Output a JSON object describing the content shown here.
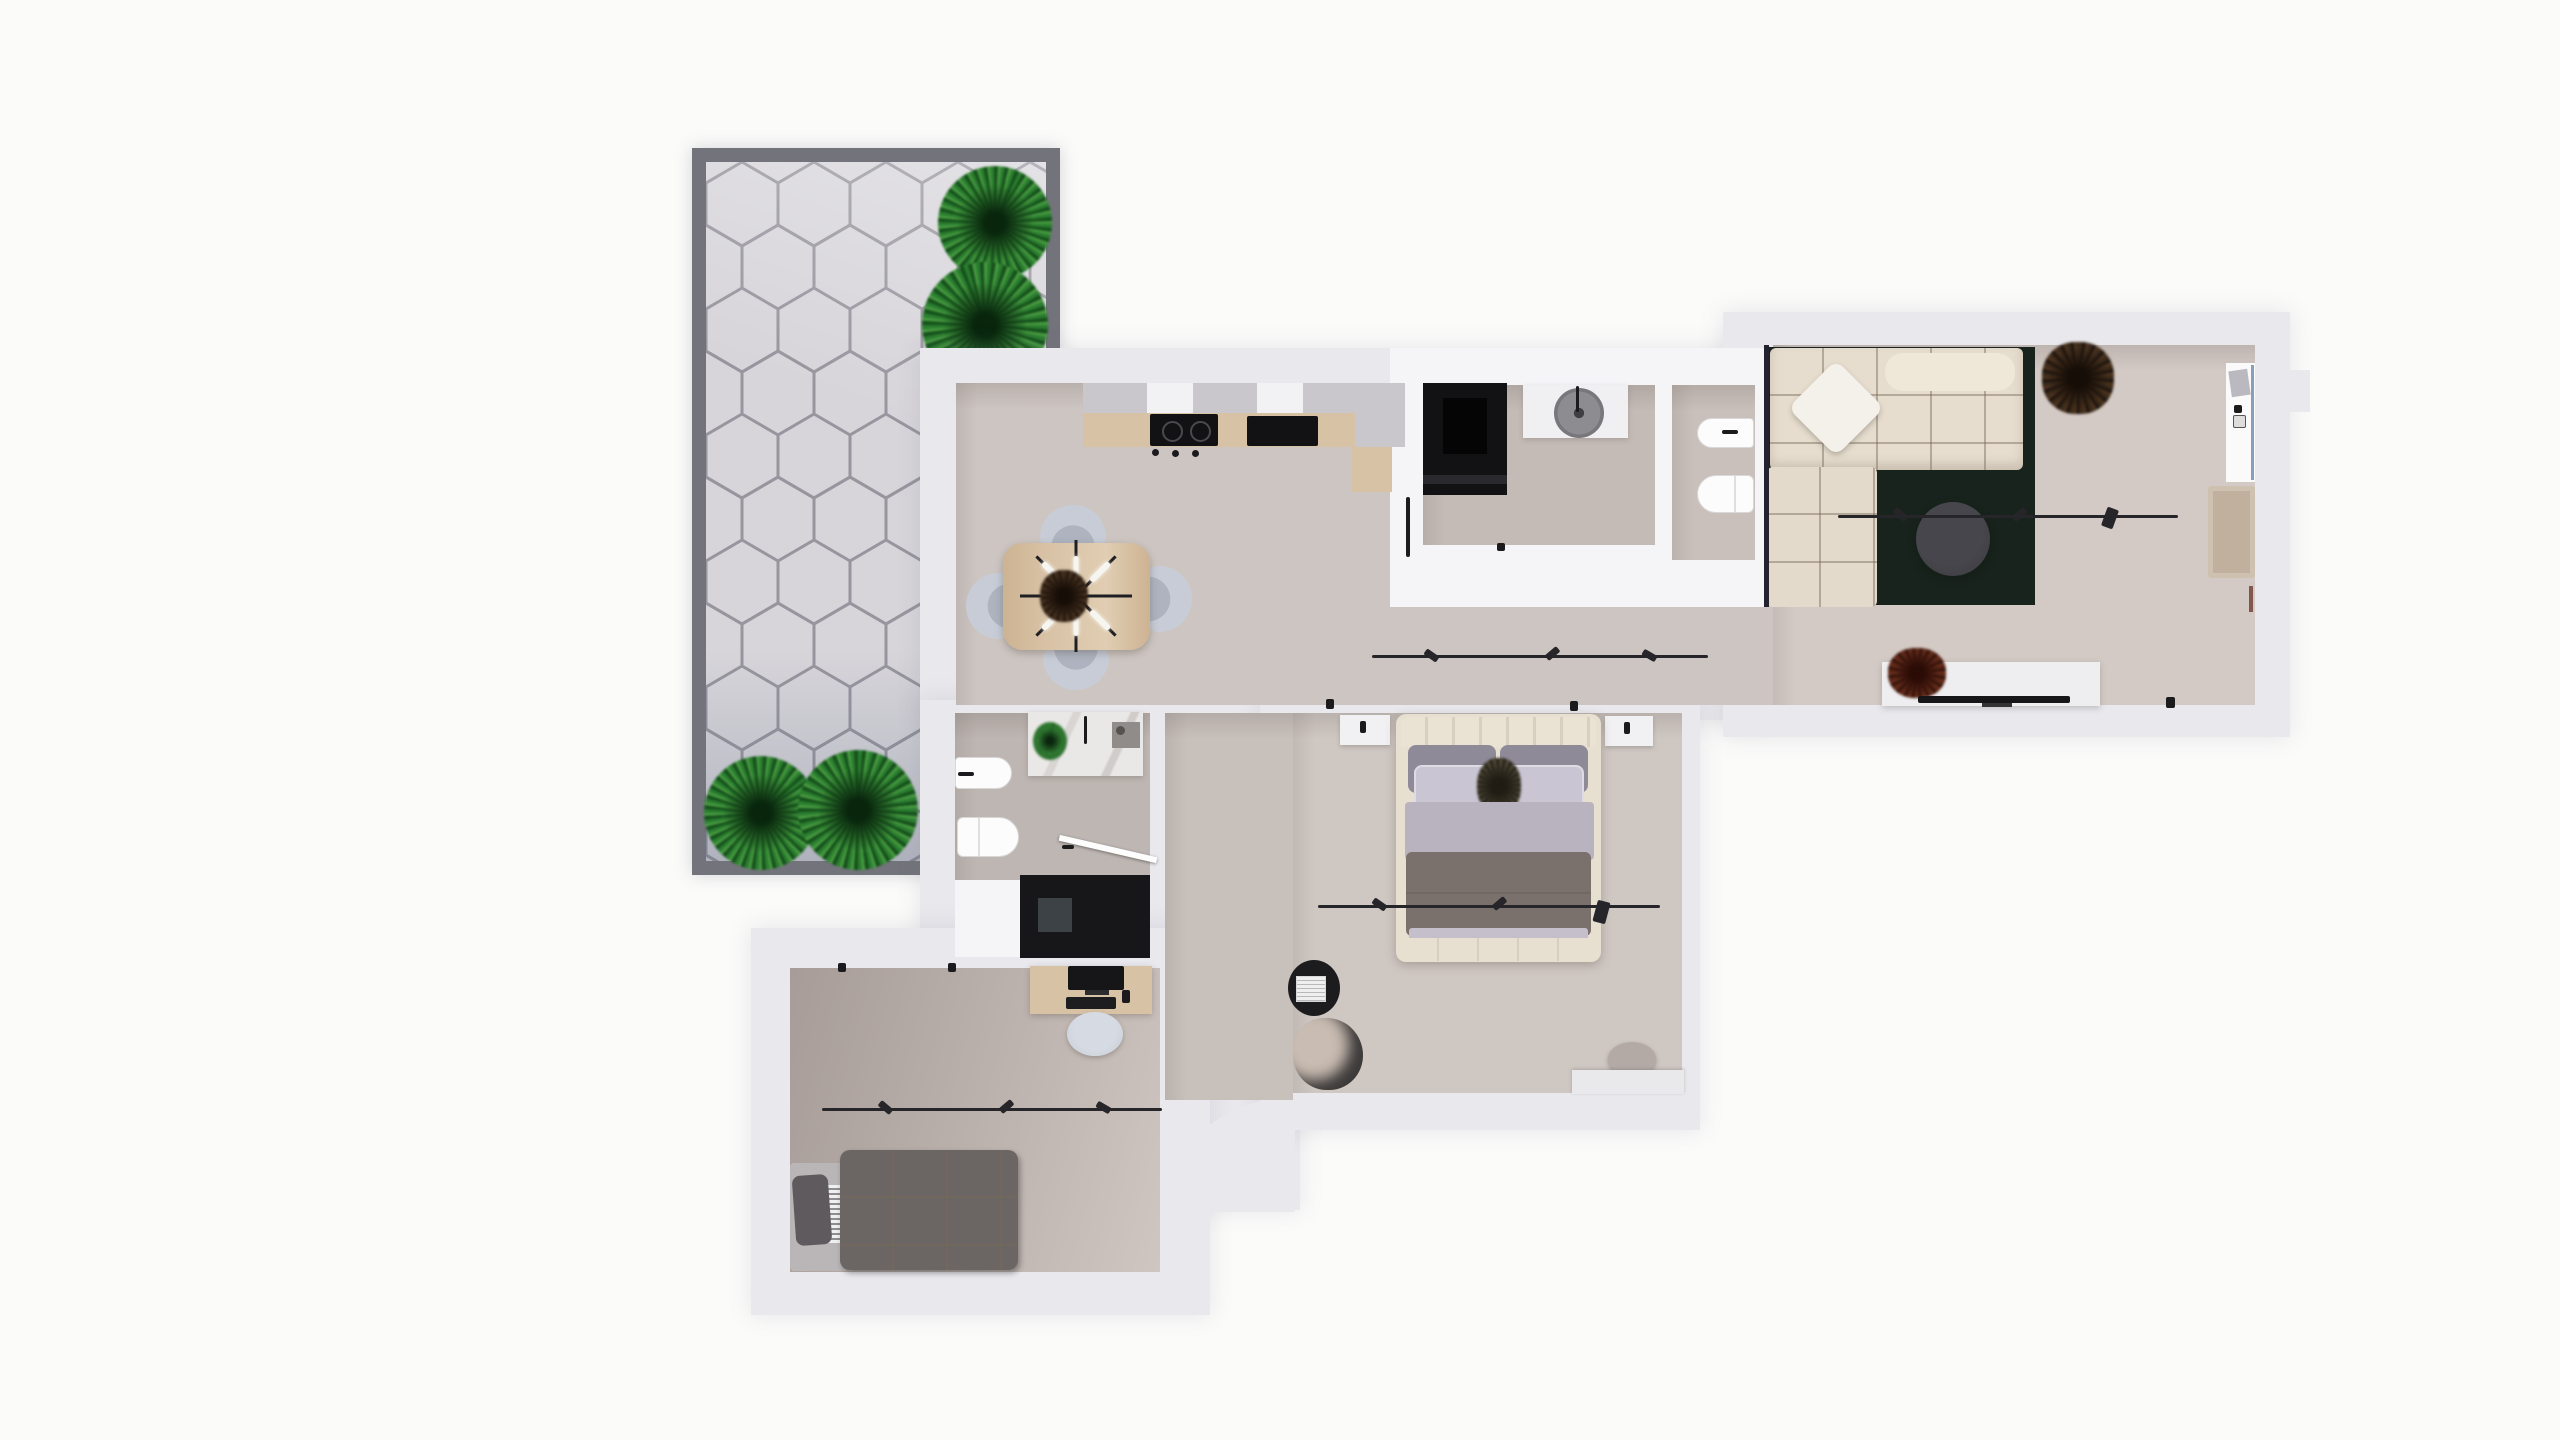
{
  "meta": {
    "description": "Top-down 3D rendered floor plan of an apartment with terrace, no visible text labels",
    "view": "orthographic top view",
    "visible_text": []
  },
  "colors": {
    "bg": "#fbfbfa",
    "wall": "#e8e8ed",
    "wall_bright": "#f5f5f8",
    "terrace_border": "#73737b",
    "terrace_tile": "#d7d5da",
    "terrace_grout": "#97959e",
    "plant_dark": "#17501d",
    "plant_mid": "#2e7d32",
    "plant_light": "#4c9a45",
    "floor_kitchen": "#cdc5c1",
    "floor_living": "#d4cac5",
    "floor_bedroom": "#cfc7c2",
    "floor_bath": "#beb6b2",
    "floor_corridor": "#c8c0bb",
    "floor_laundry": "#c4bbb6",
    "floor_wc": "#c9c0bb",
    "floor_office_dark": "#a79c98",
    "floor_office_light": "#cfc6c1",
    "wood": "#d8c2a6",
    "sofa": "#e6ddcf",
    "sofa_light": "#efe7d8",
    "pillow_white": "#f4f1ea",
    "rug": "#17231c",
    "table_dark": "#3a3a3f",
    "black": "#161618",
    "appliance": "#121214",
    "chair_gray": "#c7ccd6",
    "bed_frame": "#e7dfd0",
    "pillow_gray": "#8f8a98",
    "pillow_light": "#c9c5d2",
    "sheet": "#b8b3bf",
    "duvet": "#7a716c",
    "daybed_duvet": "#6b6564",
    "daybed_base": "#bab6b7",
    "marble": "#eae8e7",
    "track": "#26262a",
    "glass_blue": "#5577a0",
    "console_white": "#eeedef",
    "tan_chair": "#cfc1b0"
  },
  "terrace": {
    "paving": "hexagonal-tiles",
    "plants": [
      "bush-top-1",
      "bush-top-2",
      "bush-bottom-1",
      "bush-bottom-2"
    ]
  },
  "rooms": [
    {
      "name": "kitchen-dining",
      "furniture": [
        "upper-cabinets",
        "wood-counter",
        "cooktop",
        "dark-sink",
        "corner-cabinet",
        "dining-table",
        "sputnik-chandelier",
        "dining-chair-north",
        "dining-chair-south",
        "dining-chair-east",
        "dining-chair-west"
      ]
    },
    {
      "name": "laundry",
      "furniture": [
        "washing-machine",
        "white-counter",
        "round-basin",
        "door-leaf"
      ]
    },
    {
      "name": "wc",
      "furniture": [
        "bidet",
        "toilet"
      ]
    },
    {
      "name": "living-room",
      "furniture": [
        "sectional-sofa",
        "white-throw-pillow",
        "dark-green-rug",
        "round-coffee-table",
        "dried-plant",
        "tv-console",
        "tv",
        "console-plant",
        "tan-armchair",
        "wall-alcove-unit",
        "light-track"
      ]
    },
    {
      "name": "hallway",
      "furniture": [
        "light-track"
      ]
    },
    {
      "name": "bathroom",
      "furniture": [
        "marble-vanity",
        "vanity-plant",
        "bidet",
        "toilet",
        "walk-in-shower",
        "glass-door"
      ]
    },
    {
      "name": "bedroom",
      "furniture": [
        "double-bed",
        "headboard",
        "pillows",
        "duvet",
        "foot-bench",
        "nightstand-left",
        "nightstand-right",
        "black-side-table",
        "reading-pouf",
        "round-pouf",
        "low-dresser",
        "light-track"
      ]
    },
    {
      "name": "office",
      "furniture": [
        "desk",
        "monitor",
        "keyboard",
        "desk-chair",
        "daybed",
        "light-track"
      ]
    }
  ]
}
